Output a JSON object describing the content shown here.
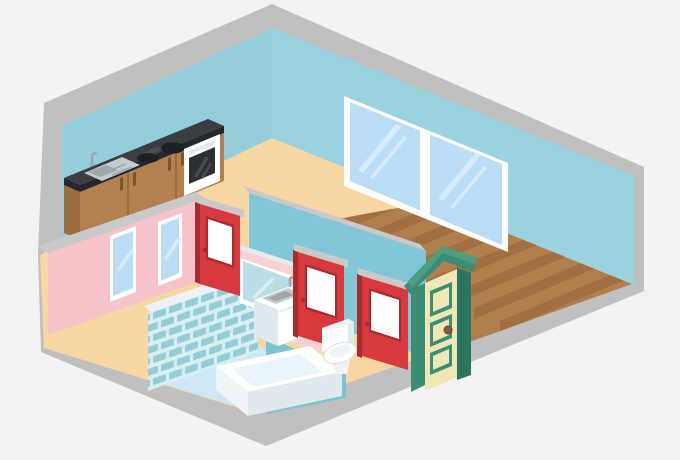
{
  "scene": {
    "description": "Isometric cutaway illustration of an apartment: kitchen counter with sink, stove burners and oven along a blue wall; living room with large double window and wood plank floor; bathroom with tiled shower wall, bathtub, vanity sink, mirror and toilet; pink interior wall with two small windows; three red interior doors; green front entry door on gray foundation base.",
    "objects": [
      "foundation-slab",
      "back-left-wall",
      "back-right-wall",
      "peach-floor",
      "wood-floor",
      "living-room-window",
      "kitchen-counter",
      "kitchen-sink",
      "stove-burners",
      "oven",
      "pink-interior-wall",
      "bathroom-window-1",
      "bathroom-window-2",
      "teal-interior-wall",
      "vanity-wall",
      "mirror",
      "shower-tile-wall",
      "half-wall-partition",
      "bathtub",
      "vanity-cabinet",
      "toilet",
      "red-door-1",
      "red-door-2",
      "red-door-3",
      "front-door"
    ]
  },
  "palette": {
    "bg": "#f3f3f3",
    "foundation": "#c0c0c0",
    "wall_blue": "#93ceda",
    "wall_blue_light": "#9ad3e0",
    "teal_wall": "#82c7d7",
    "teal_partition": "#7cc3d3",
    "pink_wall": "#f6c3c8",
    "pink_wall_light": "#f9d1d4",
    "floor_peach": "#f8d6a2",
    "floor_blue": "#cde7f7",
    "wood": "#b17e4e",
    "wood_stripe": "#a26f41",
    "tile_grout": "#d9eef1",
    "tile_brick": "#93ced6",
    "tile_rail": "#eef2f3",
    "red_door": "#d8393f",
    "red_door_dark": "#a92b31",
    "lintel_gray": "#c9c9c9",
    "cap_light": "#e9e9e9",
    "white": "#ffffff",
    "fixture_side": "#eef4f7",
    "fixture_shadow": "#dfe9ee",
    "water": "#e9f5fb",
    "metal": "#c3cad0",
    "metal_dark": "#9fa7ad",
    "glass": "#badcf4",
    "glass_streak": "#d6eafa",
    "mirror_glass": "#b9dde5",
    "counter_top": "#3a3e43",
    "counter_edge": "#24272b",
    "counter_streak": "#565b60",
    "cabinet": "#b3814f",
    "cabinet_dark": "#9c6c3d",
    "handle": "#7c5530",
    "burner": "#1e2225",
    "oven_glass": "#2b3035",
    "green_frame": "#3a8e74",
    "green_dark": "#2c7560",
    "green_light": "#4d9d82",
    "cream": "#f0e7b7",
    "knob": "#8a5a38"
  }
}
